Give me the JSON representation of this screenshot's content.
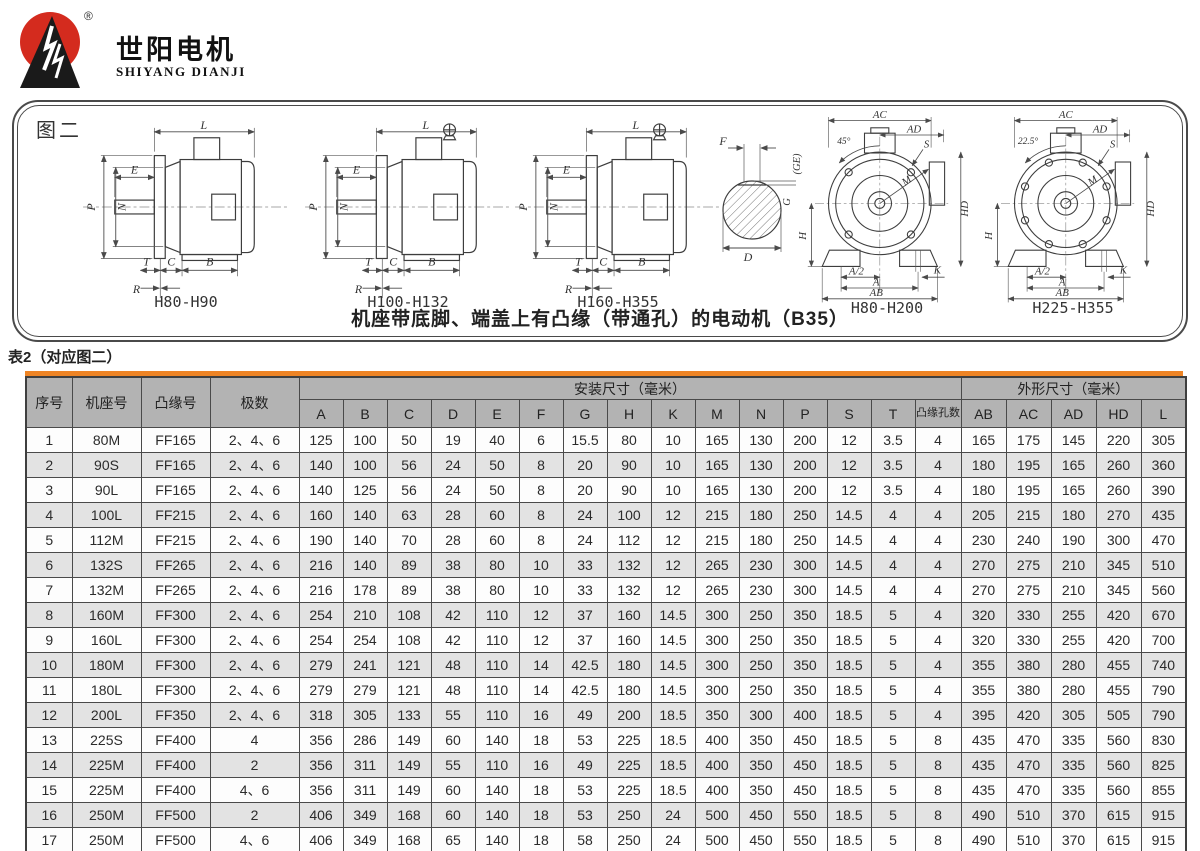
{
  "logo": {
    "name_cn": "世阳电机",
    "name_en": "SHIYANG DIANJI",
    "mark": "®"
  },
  "figure": {
    "label": "图二",
    "caption": "机座带底脚、端盖上有凸缘（带通孔）的电动机（B35）",
    "side_views": [
      {
        "name": "H80-H90"
      },
      {
        "name": "H100-H132"
      },
      {
        "name": "H160-H355"
      }
    ],
    "front_views": [
      {
        "name": "H80-H200",
        "angle": "45°"
      },
      {
        "name": "H225-H355",
        "angle": "22.5°"
      }
    ],
    "dim_labels": {
      "L": "L",
      "E": "E",
      "P": "P",
      "N": "N",
      "T": "T",
      "C": "C",
      "B": "B",
      "R": "R",
      "F": "F",
      "GE": "(GE)",
      "G": "G",
      "D": "D",
      "AC": "AC",
      "AD": "AD",
      "HD": "HD",
      "H": "H",
      "A_HALF": "A/2",
      "A": "A",
      "AB": "AB",
      "K": "K",
      "S": "S",
      "M": "M"
    }
  },
  "table": {
    "title": "表2（对应图二）",
    "corner_headers": [
      "序号",
      "机座号",
      "凸缘号",
      "极数"
    ],
    "groups": {
      "install": "安装尺寸（毫米）",
      "outline": "外形尺寸（毫米）"
    },
    "install_headers": [
      "A",
      "B",
      "C",
      "D",
      "E",
      "F",
      "G",
      "H",
      "K",
      "M",
      "N",
      "P",
      "S",
      "T",
      "凸缘孔数"
    ],
    "outline_headers": [
      "AB",
      "AC",
      "AD",
      "HD",
      "L"
    ],
    "rows": [
      [
        "1",
        "80M",
        "FF165",
        "2、4、6",
        "125",
        "100",
        "50",
        "19",
        "40",
        "6",
        "15.5",
        "80",
        "10",
        "165",
        "130",
        "200",
        "12",
        "3.5",
        "4",
        "165",
        "175",
        "145",
        "220",
        "305"
      ],
      [
        "2",
        "90S",
        "FF165",
        "2、4、6",
        "140",
        "100",
        "56",
        "24",
        "50",
        "8",
        "20",
        "90",
        "10",
        "165",
        "130",
        "200",
        "12",
        "3.5",
        "4",
        "180",
        "195",
        "165",
        "260",
        "360"
      ],
      [
        "3",
        "90L",
        "FF165",
        "2、4、6",
        "140",
        "125",
        "56",
        "24",
        "50",
        "8",
        "20",
        "90",
        "10",
        "165",
        "130",
        "200",
        "12",
        "3.5",
        "4",
        "180",
        "195",
        "165",
        "260",
        "390"
      ],
      [
        "4",
        "100L",
        "FF215",
        "2、4、6",
        "160",
        "140",
        "63",
        "28",
        "60",
        "8",
        "24",
        "100",
        "12",
        "215",
        "180",
        "250",
        "14.5",
        "4",
        "4",
        "205",
        "215",
        "180",
        "270",
        "435"
      ],
      [
        "5",
        "112M",
        "FF215",
        "2、4、6",
        "190",
        "140",
        "70",
        "28",
        "60",
        "8",
        "24",
        "112",
        "12",
        "215",
        "180",
        "250",
        "14.5",
        "4",
        "4",
        "230",
        "240",
        "190",
        "300",
        "470"
      ],
      [
        "6",
        "132S",
        "FF265",
        "2、4、6",
        "216",
        "140",
        "89",
        "38",
        "80",
        "10",
        "33",
        "132",
        "12",
        "265",
        "230",
        "300",
        "14.5",
        "4",
        "4",
        "270",
        "275",
        "210",
        "345",
        "510"
      ],
      [
        "7",
        "132M",
        "FF265",
        "2、4、6",
        "216",
        "178",
        "89",
        "38",
        "80",
        "10",
        "33",
        "132",
        "12",
        "265",
        "230",
        "300",
        "14.5",
        "4",
        "4",
        "270",
        "275",
        "210",
        "345",
        "560"
      ],
      [
        "8",
        "160M",
        "FF300",
        "2、4、6",
        "254",
        "210",
        "108",
        "42",
        "110",
        "12",
        "37",
        "160",
        "14.5",
        "300",
        "250",
        "350",
        "18.5",
        "5",
        "4",
        "320",
        "330",
        "255",
        "420",
        "670"
      ],
      [
        "9",
        "160L",
        "FF300",
        "2、4、6",
        "254",
        "254",
        "108",
        "42",
        "110",
        "12",
        "37",
        "160",
        "14.5",
        "300",
        "250",
        "350",
        "18.5",
        "5",
        "4",
        "320",
        "330",
        "255",
        "420",
        "700"
      ],
      [
        "10",
        "180M",
        "FF300",
        "2、4、6",
        "279",
        "241",
        "121",
        "48",
        "110",
        "14",
        "42.5",
        "180",
        "14.5",
        "300",
        "250",
        "350",
        "18.5",
        "5",
        "4",
        "355",
        "380",
        "280",
        "455",
        "740"
      ],
      [
        "11",
        "180L",
        "FF300",
        "2、4、6",
        "279",
        "279",
        "121",
        "48",
        "110",
        "14",
        "42.5",
        "180",
        "14.5",
        "300",
        "250",
        "350",
        "18.5",
        "5",
        "4",
        "355",
        "380",
        "280",
        "455",
        "790"
      ],
      [
        "12",
        "200L",
        "FF350",
        "2、4、6",
        "318",
        "305",
        "133",
        "55",
        "110",
        "16",
        "49",
        "200",
        "18.5",
        "350",
        "300",
        "400",
        "18.5",
        "5",
        "4",
        "395",
        "420",
        "305",
        "505",
        "790"
      ],
      [
        "13",
        "225S",
        "FF400",
        "4",
        "356",
        "286",
        "149",
        "60",
        "140",
        "18",
        "53",
        "225",
        "18.5",
        "400",
        "350",
        "450",
        "18.5",
        "5",
        "8",
        "435",
        "470",
        "335",
        "560",
        "830"
      ],
      [
        "14",
        "225M",
        "FF400",
        "2",
        "356",
        "311",
        "149",
        "55",
        "110",
        "16",
        "49",
        "225",
        "18.5",
        "400",
        "350",
        "450",
        "18.5",
        "5",
        "8",
        "435",
        "470",
        "335",
        "560",
        "825"
      ],
      [
        "15",
        "225M",
        "FF400",
        "4、6",
        "356",
        "311",
        "149",
        "60",
        "140",
        "18",
        "53",
        "225",
        "18.5",
        "400",
        "350",
        "450",
        "18.5",
        "5",
        "8",
        "435",
        "470",
        "335",
        "560",
        "855"
      ],
      [
        "16",
        "250M",
        "FF500",
        "2",
        "406",
        "349",
        "168",
        "60",
        "140",
        "18",
        "53",
        "250",
        "24",
        "500",
        "450",
        "550",
        "18.5",
        "5",
        "8",
        "490",
        "510",
        "370",
        "615",
        "915"
      ],
      [
        "17",
        "250M",
        "FF500",
        "4、6",
        "406",
        "349",
        "168",
        "65",
        "140",
        "18",
        "58",
        "250",
        "24",
        "500",
        "450",
        "550",
        "18.5",
        "5",
        "8",
        "490",
        "510",
        "370",
        "615",
        "915"
      ]
    ]
  },
  "colors": {
    "accent_orange": "#ee8425",
    "header_gray": "#b3b3b3",
    "row_alt": "#e3e3e3",
    "logo_red": "#d42b1e"
  }
}
